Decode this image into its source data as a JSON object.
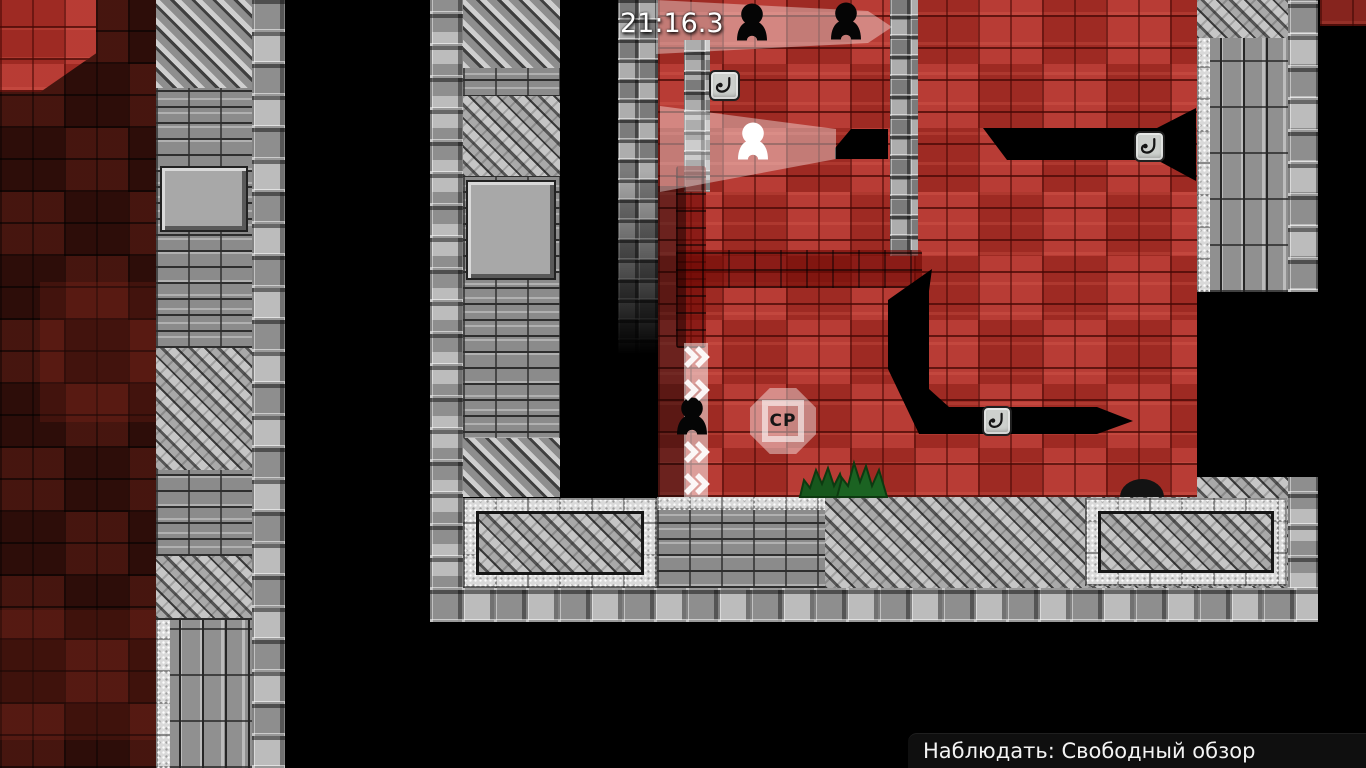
{
  "hud": {
    "timer": "21:16.3",
    "spectate_label": "Наблюдать: Свободный обзор"
  },
  "map": {
    "checkpoint_label": "CP",
    "icons": {
      "hook": "hook-icon",
      "spectator_ghost": "spectator-ghost-icon",
      "speedup_chevron": "speedup-chevron-icon"
    },
    "colors": {
      "red_wall": "#b43028",
      "red_dark": "#38100b",
      "stone_grey": "#a2a2a2",
      "tunnel_black": "#000000",
      "light_overlay": "rgba(255,255,255,0.45)",
      "grass_green": "#17571d"
    }
  }
}
